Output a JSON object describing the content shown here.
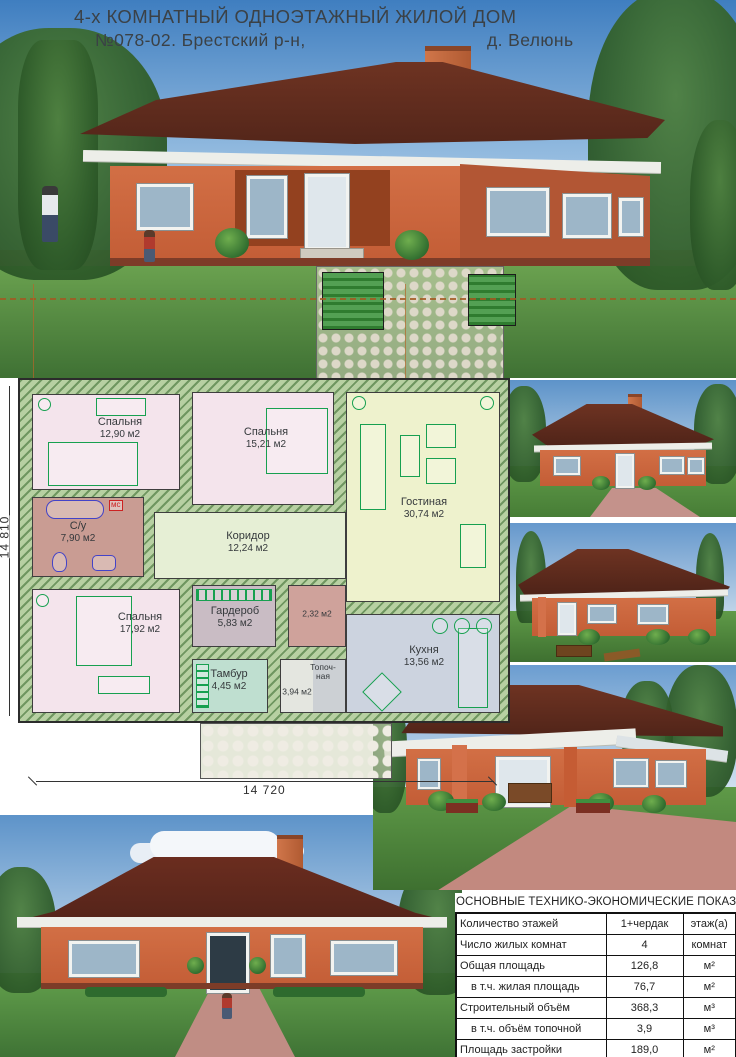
{
  "title": {
    "line1": "4-х КОМНАТНЫЙ ОДНОЭТАЖНЫЙ ЖИЛОЙ ДОМ",
    "line2_left": "№078-02.  Брестский р-н,",
    "line2_right": "д. Велюнь"
  },
  "plan": {
    "dim_width": "14 720",
    "dim_height": "14 810",
    "rooms": [
      {
        "name": "Спальня",
        "area": "12,90 м2"
      },
      {
        "name": "Спальня",
        "area": "15,21 м2"
      },
      {
        "name": "Гостиная",
        "area": "30,74 м2"
      },
      {
        "name": "С/у",
        "area": "7,90 м2"
      },
      {
        "name": "Коридор",
        "area": "12,24 м2"
      },
      {
        "name": "Спальня",
        "area": "17,92 м2"
      },
      {
        "name": "Гардероб",
        "area": "5,83 м2"
      },
      {
        "name": "",
        "area": "2,32 м2"
      },
      {
        "name": "Тамбур",
        "area": "4,45 м2"
      },
      {
        "name": "",
        "area": "3,94 м2"
      },
      {
        "name": "Топоч-ная",
        "area": ""
      },
      {
        "name": "Кухня",
        "area": "13,56 м2"
      }
    ],
    "labels": {
      "mc": "мс"
    }
  },
  "table": {
    "title": "ОСНОВНЫЕ ТЕХНИКО-ЭКОНОМИЧЕСКИЕ ПОКАЗАТЕЛИ",
    "rows": [
      {
        "label": "Количество этажей",
        "value": "1+чердак",
        "unit": "этаж(а)"
      },
      {
        "label": "Число жилых комнат",
        "value": "4",
        "unit": "комнат"
      },
      {
        "label": "Общая площадь",
        "value": "126,8",
        "unit": "м²"
      },
      {
        "label": "в т.ч. жилая площадь",
        "value": "76,7",
        "unit": "м²"
      },
      {
        "label": "Строительный объём",
        "value": "368,3",
        "unit": "м³"
      },
      {
        "label": "в т.ч. объём топочной",
        "value": "3,9",
        "unit": "м³"
      },
      {
        "label": "Площадь застройки",
        "value": "189,0",
        "unit": "м²"
      }
    ]
  },
  "colors": {
    "house_wall": "#cf6b42",
    "roof": "#5e2a1f",
    "sky": "#4f86c4",
    "lawn": "#5a9b4a",
    "plan_wall_hatch": "#9dbb8a",
    "dimension_accent": "#b4652a"
  }
}
